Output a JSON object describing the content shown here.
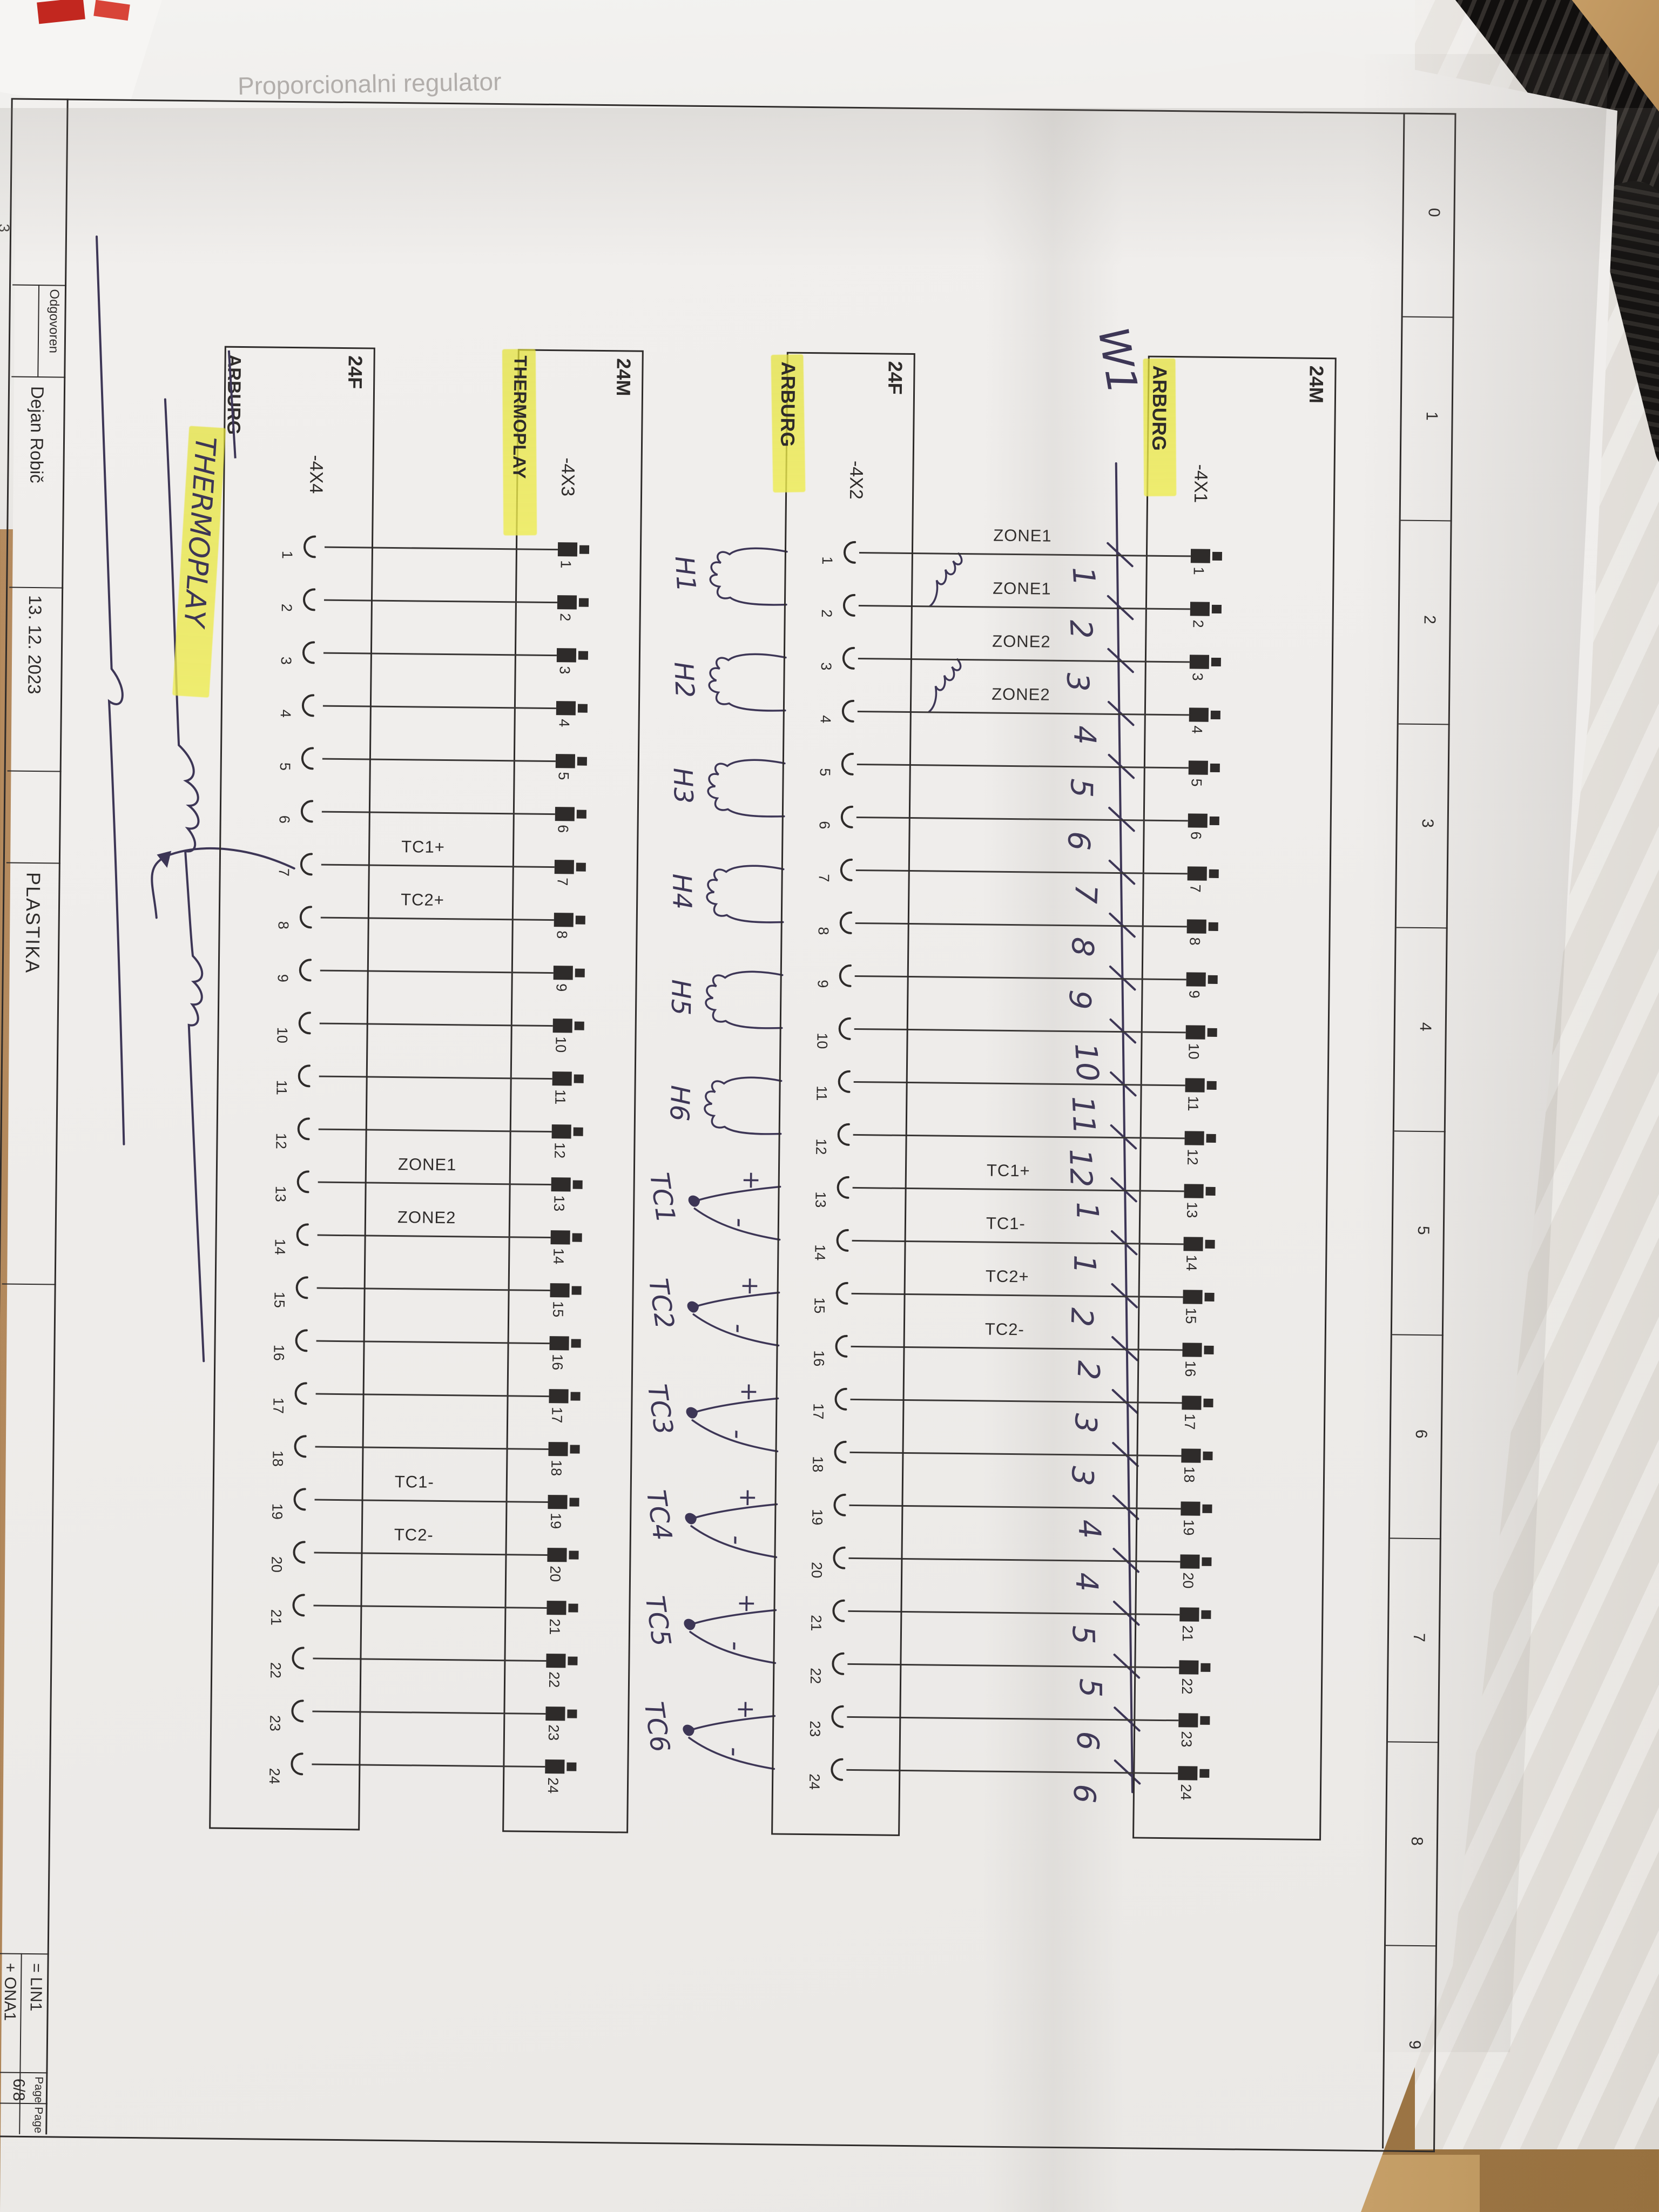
{
  "photo": {
    "background_text": "Proporcionalni regulator",
    "stray_page_number": "3"
  },
  "frame": {
    "grid_numbers": [
      "0",
      "1",
      "2",
      "3",
      "4",
      "5",
      "6",
      "7",
      "8",
      "9"
    ]
  },
  "title_block": {
    "responsible_label": "Odgovoren",
    "responsible_value": "Dejan Robič",
    "date": "13. 12. 2023",
    "company": "PLASTIKA",
    "function_designation": "= LIN1",
    "location_designation": "+ ONA1",
    "page_label": "Page",
    "page_value": "6/8",
    "page_label_2": "Page",
    "margin_stamp": "+NAC/4"
  },
  "connectors": [
    {
      "tag": "-4X1",
      "brand": "ARBURG",
      "brand_highlighted": true,
      "type": "24M",
      "pin_style": "male",
      "pin_count": 24,
      "wire_labels": [
        {
          "pin": 1,
          "label": "ZONE1"
        },
        {
          "pin": 2,
          "label": "ZONE1"
        },
        {
          "pin": 3,
          "label": "ZONE2"
        },
        {
          "pin": 4,
          "label": "ZONE2"
        },
        {
          "pin": 13,
          "label": "TC1+"
        },
        {
          "pin": 14,
          "label": "TC1-"
        },
        {
          "pin": 15,
          "label": "TC2+"
        },
        {
          "pin": 16,
          "label": "TC2-"
        }
      ]
    },
    {
      "tag": "-4X2",
      "brand": "ARBURG",
      "brand_highlighted": true,
      "type": "24F",
      "pin_style": "female",
      "pin_count": 24
    },
    {
      "tag": "-4X3",
      "brand": "THERMOPLAY",
      "brand_highlighted": true,
      "type": "24M",
      "pin_style": "male",
      "pin_count": 24,
      "wire_labels": [
        {
          "pin": 7,
          "label": "TC1+"
        },
        {
          "pin": 8,
          "label": "TC2+"
        },
        {
          "pin": 13,
          "label": "ZONE1"
        },
        {
          "pin": 14,
          "label": "ZONE2"
        },
        {
          "pin": 19,
          "label": "TC1-"
        },
        {
          "pin": 20,
          "label": "TC2-"
        }
      ]
    },
    {
      "tag": "-4X4",
      "brand": "ARBURG",
      "brand_struck": true,
      "handwritten_brand": "THERMOPLAY",
      "type": "24F",
      "pin_style": "female",
      "pin_count": 24
    }
  ],
  "handwritten": {
    "cable_label": "W1",
    "wire_numbers": [
      "1",
      "2",
      "3",
      "4",
      "5",
      "6",
      "7",
      "8",
      "9",
      "10",
      "11",
      "12",
      "1",
      "1",
      "2",
      "2",
      "3",
      "3",
      "4",
      "4",
      "5",
      "5",
      "6",
      "6"
    ],
    "heater_labels": [
      "H1",
      "H2",
      "H3",
      "H4",
      "H5",
      "H6"
    ],
    "thermocouple_labels": [
      "TC1",
      "TC2",
      "TC3",
      "TC4",
      "TC5",
      "TC6"
    ],
    "plus_sign": "+",
    "minus_sign": "-"
  }
}
